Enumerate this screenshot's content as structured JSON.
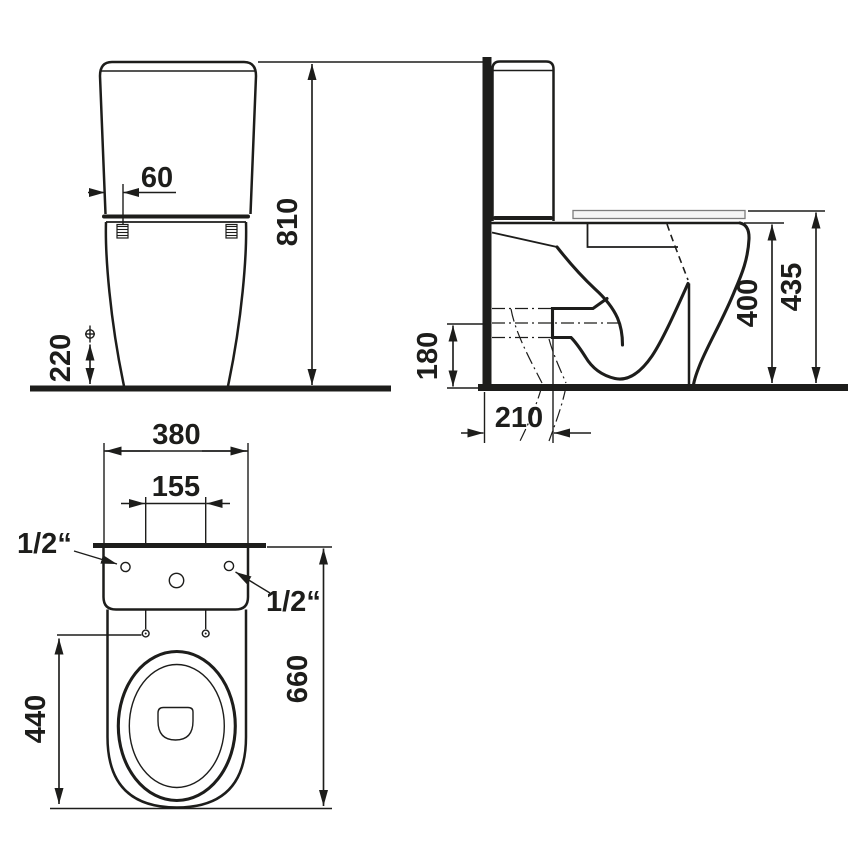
{
  "drawing": {
    "front_view": {
      "dims": {
        "cistern_edge_offset": "60",
        "overall_height": "810",
        "fixing_height": "220"
      }
    },
    "side_view": {
      "dims": {
        "outlet_height": "180",
        "outlet_distance": "210",
        "bowl_height": "400",
        "seat_height": "435"
      }
    },
    "top_view": {
      "dims": {
        "width": "380",
        "inlet_centres": "155",
        "depth": "660",
        "seat_fixing_depth": "440",
        "inlet_left": "1/2“",
        "inlet_right": "1/2“"
      }
    }
  },
  "colors": {
    "line": "#1d1d1b",
    "background": "#ffffff",
    "lid_outline": "#7d7d7d",
    "lid_fill": "#f5f5f5"
  }
}
